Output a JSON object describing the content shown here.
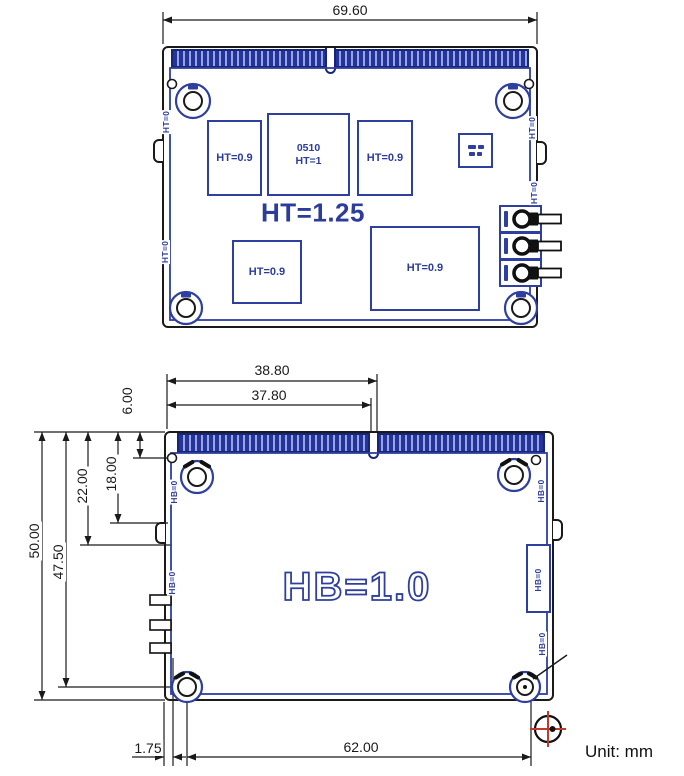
{
  "unit_note": "Unit: mm",
  "colors": {
    "accent_blue": "#2e3f9f",
    "dark_blue": "#16247a",
    "line_black": "#1a1a1a",
    "datum_red": "#c0392b"
  },
  "top_view": {
    "view_name": "module top side",
    "dim_width": "69.60",
    "title_label": "HT=1.25",
    "components": [
      {
        "label": "HT=0.9"
      },
      {
        "line1": "0510",
        "line2": "HT=1"
      },
      {
        "label": "HT=0.9"
      },
      {
        "label": "HT=0.9"
      },
      {
        "label": "HT=0.9"
      }
    ],
    "edge_labels": [
      "HT=0",
      "HT=0",
      "HT=0",
      "HT=0"
    ]
  },
  "bottom_view": {
    "view_name": "module bottom side",
    "board_label": "HB=1.0",
    "dims": {
      "notch_far": "38.80",
      "notch_near": "37.80",
      "conn_offset": "6.00",
      "step_top": "18.00",
      "step_bottom": "22.00",
      "hole_row": "47.50",
      "height": "50.00",
      "edge_to_hole": "1.75",
      "hole_span": "62.00"
    },
    "edge_labels": [
      "HB=0",
      "HB=0",
      "HB=0",
      "HB=0",
      "HB=0"
    ]
  }
}
